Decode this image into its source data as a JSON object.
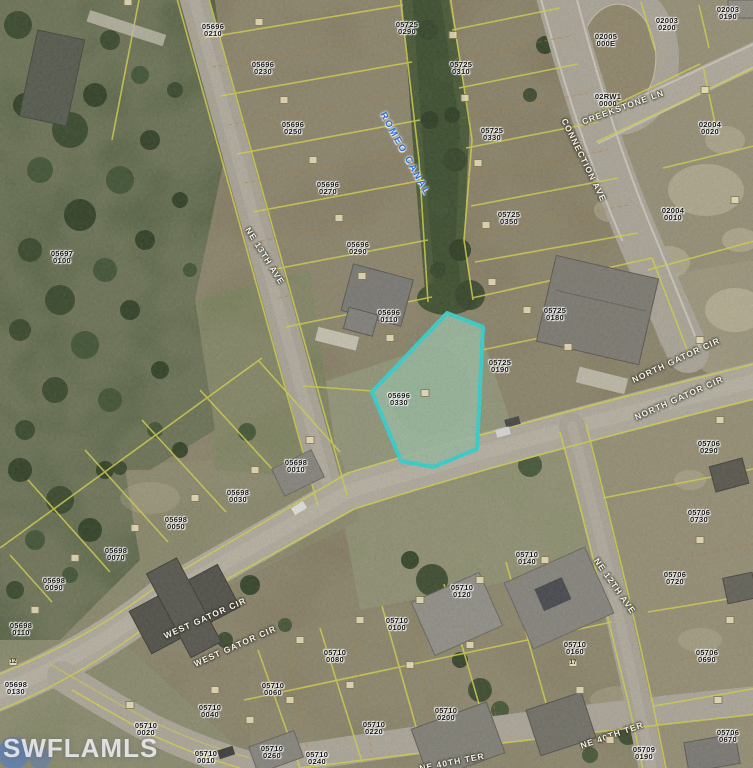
{
  "map": {
    "watermark": "SWFLAMLS",
    "highlight_parcel": {
      "id": "05696 0330",
      "outline_color": "#39e0dc"
    },
    "colors": {
      "parcel_line": "#e3e050",
      "highlight": "#39e0dc",
      "canal_text": "#2e6fd6",
      "road": "#bcb6a7"
    },
    "parcels": [
      {
        "id": "05696 0210",
        "x": 213,
        "y": 30
      },
      {
        "id": "05696 0230",
        "x": 263,
        "y": 68
      },
      {
        "id": "05696 0250",
        "x": 293,
        "y": 128
      },
      {
        "id": "05696 0270",
        "x": 328,
        "y": 188
      },
      {
        "id": "05696 0290",
        "x": 358,
        "y": 248
      },
      {
        "id": "05696 0110",
        "x": 389,
        "y": 316
      },
      {
        "id": "05696 0330",
        "x": 399,
        "y": 399
      },
      {
        "id": "05725 0290",
        "x": 407,
        "y": 28
      },
      {
        "id": "05725 0310",
        "x": 461,
        "y": 68
      },
      {
        "id": "05725 0330",
        "x": 492,
        "y": 134
      },
      {
        "id": "05725 0350",
        "x": 509,
        "y": 218
      },
      {
        "id": "05725 0180",
        "x": 555,
        "y": 314
      },
      {
        "id": "05725 0190",
        "x": 500,
        "y": 366
      },
      {
        "id": "02003 0200",
        "x": 667,
        "y": 24
      },
      {
        "id": "02003 0190",
        "x": 728,
        "y": 13
      },
      {
        "id": "02005 000E",
        "x": 606,
        "y": 40
      },
      {
        "id": "02RW1 0000",
        "x": 608,
        "y": 100
      },
      {
        "id": "02004 0020",
        "x": 710,
        "y": 128
      },
      {
        "id": "02004 0010",
        "x": 673,
        "y": 214
      },
      {
        "id": "05697 0100",
        "x": 62,
        "y": 257
      },
      {
        "id": "05706 0290",
        "x": 709,
        "y": 447
      },
      {
        "id": "05706 0730",
        "x": 699,
        "y": 516
      },
      {
        "id": "05706 0720",
        "x": 675,
        "y": 578
      },
      {
        "id": "05706 0690",
        "x": 707,
        "y": 656
      },
      {
        "id": "05706 0670",
        "x": 728,
        "y": 736
      },
      {
        "id": "05710 0160",
        "x": 575,
        "y": 648
      },
      {
        "id": "05710 0140",
        "x": 527,
        "y": 558
      },
      {
        "id": "05710 0120",
        "x": 462,
        "y": 591
      },
      {
        "id": "05710 0100",
        "x": 397,
        "y": 624
      },
      {
        "id": "05710 0080",
        "x": 335,
        "y": 656
      },
      {
        "id": "05710 0060",
        "x": 273,
        "y": 689
      },
      {
        "id": "05710 0200",
        "x": 446,
        "y": 714
      },
      {
        "id": "05710 0220",
        "x": 374,
        "y": 728
      },
      {
        "id": "05710 0240",
        "x": 317,
        "y": 758
      },
      {
        "id": "05710 0260",
        "x": 272,
        "y": 752
      },
      {
        "id": "05709 0190",
        "x": 644,
        "y": 753
      },
      {
        "id": "05698 0010",
        "x": 296,
        "y": 466
      },
      {
        "id": "05698 0030",
        "x": 238,
        "y": 496
      },
      {
        "id": "05698 0050",
        "x": 176,
        "y": 523
      },
      {
        "id": "05698 0070",
        "x": 116,
        "y": 554
      },
      {
        "id": "05698 0090",
        "x": 54,
        "y": 584
      },
      {
        "id": "05698 0110",
        "x": 21,
        "y": 629
      },
      {
        "id": "05698 0130",
        "x": 16,
        "y": 688
      },
      {
        "id": "05710 0020",
        "x": 146,
        "y": 729
      },
      {
        "id": "05710 0040",
        "x": 210,
        "y": 711
      },
      {
        "id": "05710 0010",
        "x": 206,
        "y": 757
      }
    ],
    "streets": [
      {
        "name": "NE 13TH AVE",
        "x": 265,
        "y": 256,
        "rot": 58,
        "style": "road"
      },
      {
        "name": "ROMEO CANAL",
        "x": 405,
        "y": 154,
        "rot": 61,
        "style": "canal"
      },
      {
        "name": "CONNECTION AVE",
        "x": 584,
        "y": 160,
        "rot": 64,
        "style": "road"
      },
      {
        "name": "CREEKSTONE LN",
        "x": 623,
        "y": 107,
        "rot": -20,
        "style": "road"
      },
      {
        "name": "NORTH GATOR CIR",
        "x": 676,
        "y": 360,
        "rot": -25,
        "style": "road"
      },
      {
        "name": "NORTH GATOR CIR",
        "x": 679,
        "y": 398,
        "rot": -24,
        "style": "road"
      },
      {
        "name": "WEST GATOR CIR",
        "x": 205,
        "y": 618,
        "rot": -24,
        "style": "road"
      },
      {
        "name": "WEST GATOR CIR",
        "x": 235,
        "y": 646,
        "rot": -24,
        "style": "road"
      },
      {
        "name": "NE 12TH AVE",
        "x": 615,
        "y": 586,
        "rot": 55,
        "style": "road"
      },
      {
        "name": "NE 40TH TER",
        "x": 612,
        "y": 735,
        "rot": -19,
        "style": "road"
      },
      {
        "name": "NE 40TH TER",
        "x": 452,
        "y": 762,
        "rot": -11,
        "style": "road"
      }
    ],
    "lot_markers_labeled": [
      {
        "n": "17",
        "x": 573,
        "y": 663
      },
      {
        "n": "12",
        "x": 13,
        "y": 662
      }
    ]
  }
}
